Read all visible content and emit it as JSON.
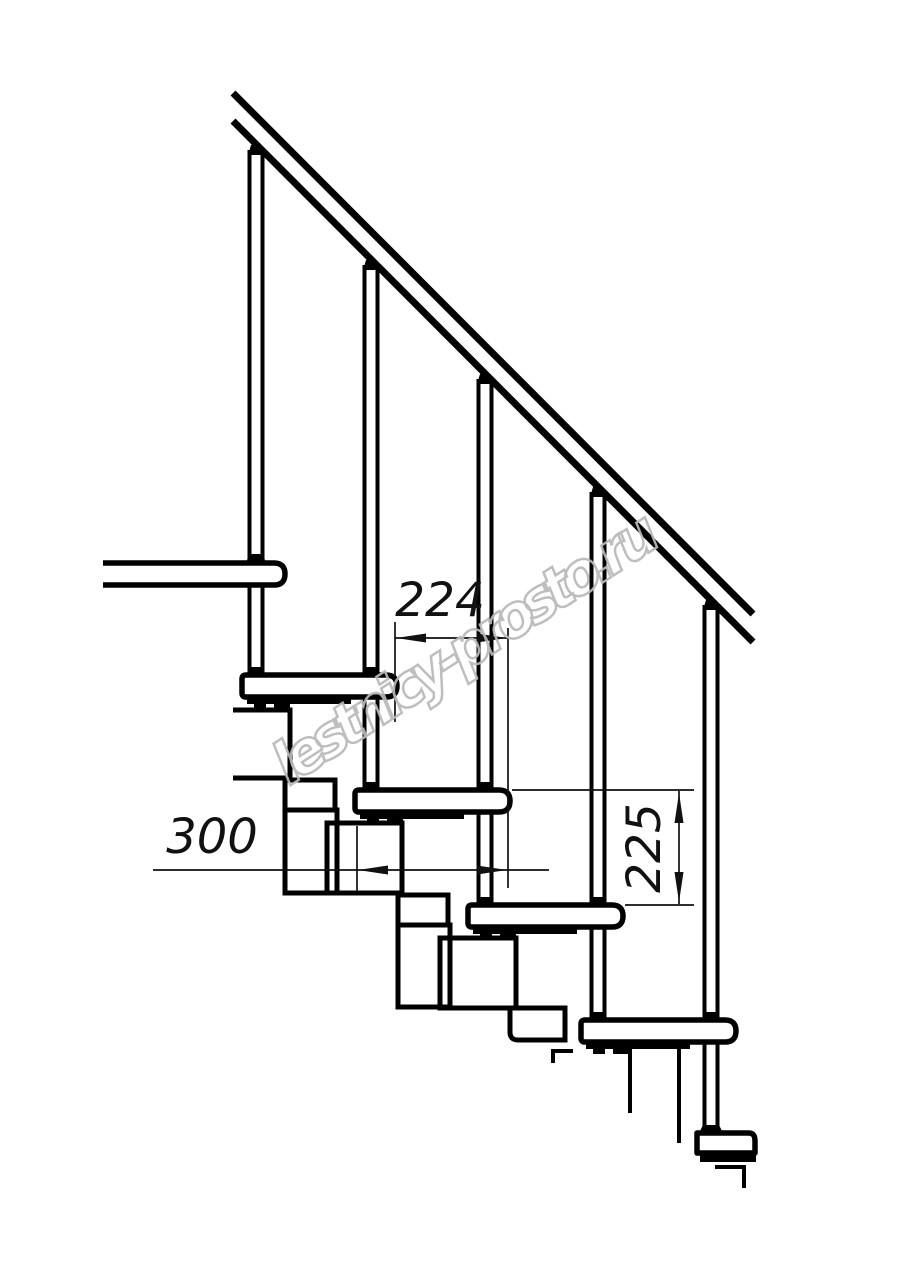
{
  "drawing": {
    "dimensions": {
      "step_run": "224",
      "tread_depth": "300",
      "step_rise": "225"
    },
    "watermark": "lestnicy-prosto.ru",
    "colors": {
      "line": "#000000",
      "background": "#ffffff",
      "watermark_stroke": "#b9b9b9"
    }
  }
}
